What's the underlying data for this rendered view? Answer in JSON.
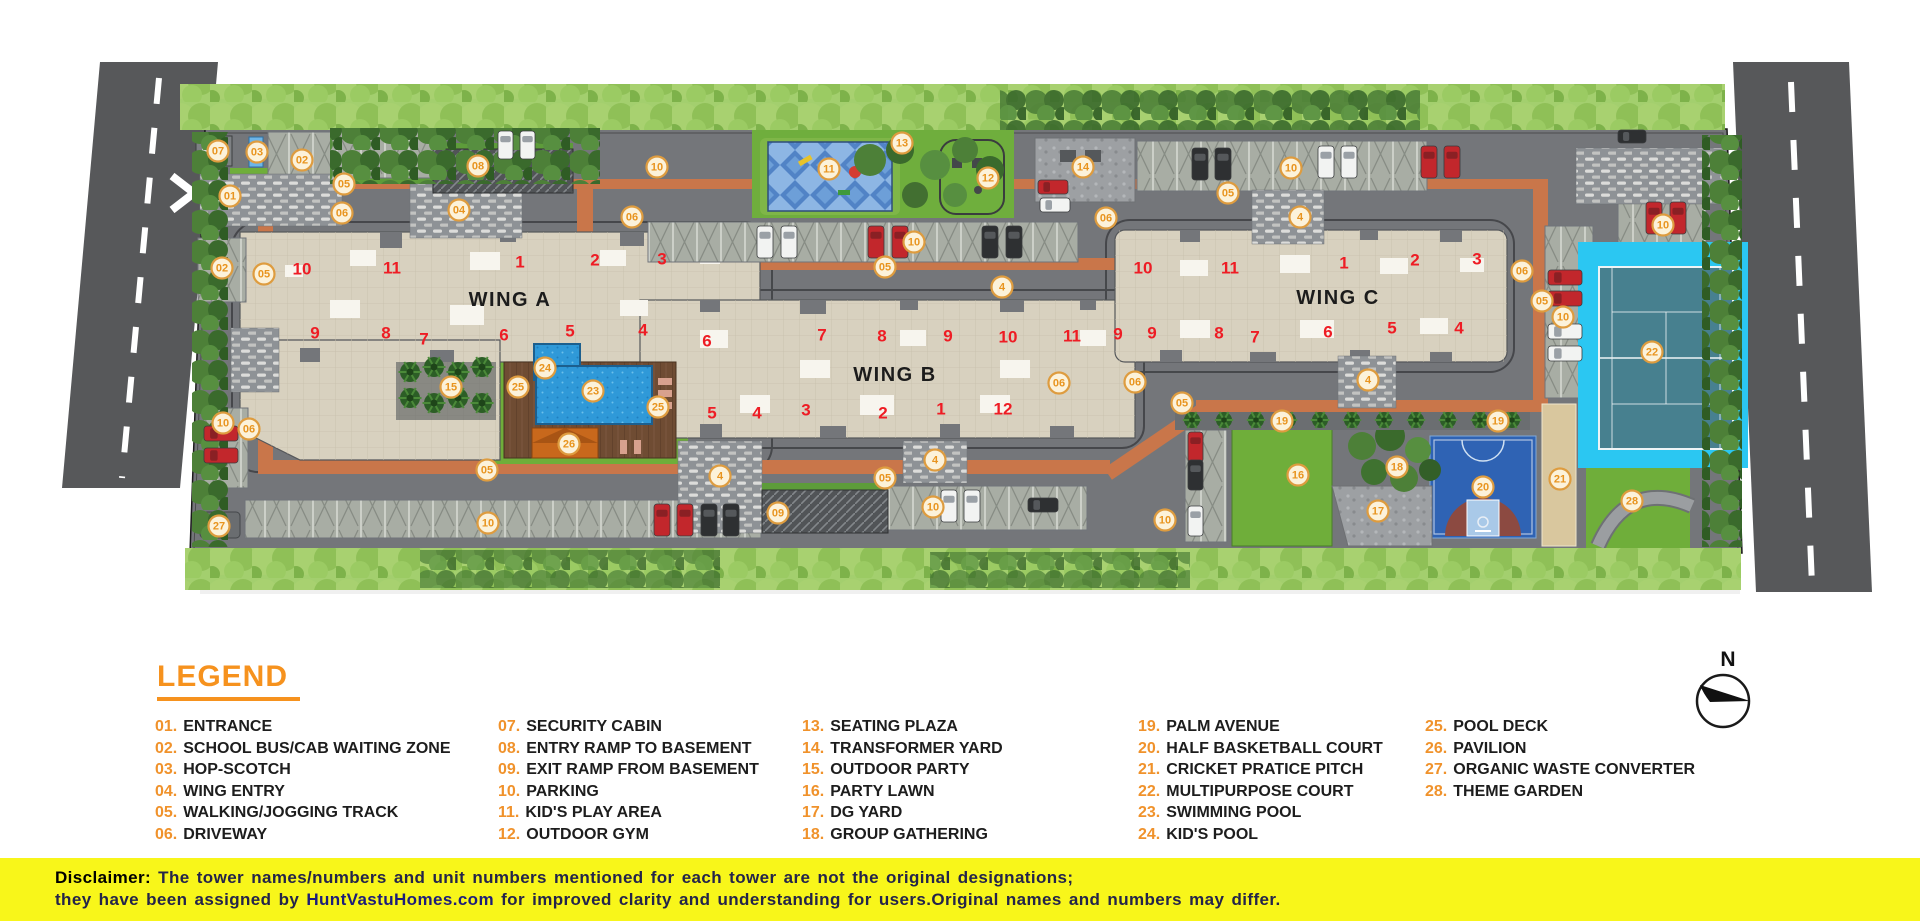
{
  "plan": {
    "wing_labels": [
      {
        "t": "WING A",
        "x": 510,
        "y": 300
      },
      {
        "t": "WING B",
        "x": 895,
        "y": 375
      },
      {
        "t": "WING C",
        "x": 1338,
        "y": 298
      }
    ],
    "unit_numbers": [
      {
        "t": "10",
        "x": 302,
        "y": 269
      },
      {
        "t": "11",
        "x": 392,
        "y": 268
      },
      {
        "t": "1",
        "x": 520,
        "y": 262
      },
      {
        "t": "2",
        "x": 595,
        "y": 260
      },
      {
        "t": "3",
        "x": 662,
        "y": 259
      },
      {
        "t": "9",
        "x": 315,
        "y": 333
      },
      {
        "t": "8",
        "x": 386,
        "y": 333
      },
      {
        "t": "7",
        "x": 424,
        "y": 339
      },
      {
        "t": "6",
        "x": 504,
        "y": 335
      },
      {
        "t": "5",
        "x": 570,
        "y": 331
      },
      {
        "t": "4",
        "x": 643,
        "y": 330
      },
      {
        "t": "6",
        "x": 707,
        "y": 341
      },
      {
        "t": "7",
        "x": 822,
        "y": 335
      },
      {
        "t": "8",
        "x": 882,
        "y": 336
      },
      {
        "t": "9",
        "x": 948,
        "y": 336
      },
      {
        "t": "10",
        "x": 1008,
        "y": 337
      },
      {
        "t": "11",
        "x": 1072,
        "y": 336
      },
      {
        "t": "9",
        "x": 1118,
        "y": 334
      },
      {
        "t": "5",
        "x": 712,
        "y": 413
      },
      {
        "t": "4",
        "x": 757,
        "y": 413
      },
      {
        "t": "3",
        "x": 806,
        "y": 410
      },
      {
        "t": "2",
        "x": 883,
        "y": 413
      },
      {
        "t": "1",
        "x": 941,
        "y": 409
      },
      {
        "t": "12",
        "x": 1003,
        "y": 409
      },
      {
        "t": "10",
        "x": 1143,
        "y": 268
      },
      {
        "t": "11",
        "x": 1230,
        "y": 268
      },
      {
        "t": "1",
        "x": 1344,
        "y": 263
      },
      {
        "t": "2",
        "x": 1415,
        "y": 260
      },
      {
        "t": "3",
        "x": 1477,
        "y": 259
      },
      {
        "t": "9",
        "x": 1152,
        "y": 333
      },
      {
        "t": "8",
        "x": 1219,
        "y": 333
      },
      {
        "t": "7",
        "x": 1255,
        "y": 337
      },
      {
        "t": "6",
        "x": 1328,
        "y": 332
      },
      {
        "t": "5",
        "x": 1392,
        "y": 328
      },
      {
        "t": "4",
        "x": 1459,
        "y": 328
      }
    ],
    "markers": [
      {
        "t": "07",
        "x": 218,
        "y": 151
      },
      {
        "t": "03",
        "x": 257,
        "y": 152
      },
      {
        "t": "02",
        "x": 302,
        "y": 160
      },
      {
        "t": "05",
        "x": 344,
        "y": 184
      },
      {
        "t": "01",
        "x": 230,
        "y": 196
      },
      {
        "t": "06",
        "x": 342,
        "y": 213
      },
      {
        "t": "04",
        "x": 459,
        "y": 210
      },
      {
        "t": "08",
        "x": 478,
        "y": 166
      },
      {
        "t": "02",
        "x": 222,
        "y": 268
      },
      {
        "t": "05",
        "x": 264,
        "y": 274
      },
      {
        "t": "10",
        "x": 657,
        "y": 167
      },
      {
        "t": "06",
        "x": 632,
        "y": 217
      },
      {
        "t": "11",
        "x": 829,
        "y": 169
      },
      {
        "t": "13",
        "x": 902,
        "y": 143
      },
      {
        "t": "12",
        "x": 988,
        "y": 178
      },
      {
        "t": "14",
        "x": 1083,
        "y": 167
      },
      {
        "t": "10",
        "x": 914,
        "y": 242
      },
      {
        "t": "05",
        "x": 885,
        "y": 267
      },
      {
        "t": "4",
        "x": 1002,
        "y": 287
      },
      {
        "t": "06",
        "x": 1106,
        "y": 218
      },
      {
        "t": "10",
        "x": 1291,
        "y": 168
      },
      {
        "t": "05",
        "x": 1228,
        "y": 193
      },
      {
        "t": "4",
        "x": 1300,
        "y": 217
      },
      {
        "t": "10",
        "x": 1663,
        "y": 225
      },
      {
        "t": "06",
        "x": 1522,
        "y": 271
      },
      {
        "t": "05",
        "x": 1542,
        "y": 301
      },
      {
        "t": "10",
        "x": 1563,
        "y": 317
      },
      {
        "t": "22",
        "x": 1652,
        "y": 352
      },
      {
        "t": "06",
        "x": 1135,
        "y": 382
      },
      {
        "t": "05",
        "x": 1182,
        "y": 403
      },
      {
        "t": "4",
        "x": 1368,
        "y": 380
      },
      {
        "t": "19",
        "x": 1282,
        "y": 421
      },
      {
        "t": "19",
        "x": 1498,
        "y": 421
      },
      {
        "t": "16",
        "x": 1298,
        "y": 475
      },
      {
        "t": "18",
        "x": 1397,
        "y": 467
      },
      {
        "t": "17",
        "x": 1378,
        "y": 511
      },
      {
        "t": "20",
        "x": 1483,
        "y": 487
      },
      {
        "t": "21",
        "x": 1560,
        "y": 479
      },
      {
        "t": "28",
        "x": 1632,
        "y": 501
      },
      {
        "t": "15",
        "x": 451,
        "y": 387
      },
      {
        "t": "24",
        "x": 545,
        "y": 368
      },
      {
        "t": "25",
        "x": 518,
        "y": 387
      },
      {
        "t": "23",
        "x": 593,
        "y": 391
      },
      {
        "t": "25",
        "x": 658,
        "y": 407
      },
      {
        "t": "26",
        "x": 569,
        "y": 444
      },
      {
        "t": "06",
        "x": 249,
        "y": 429
      },
      {
        "t": "10",
        "x": 223,
        "y": 423
      },
      {
        "t": "27",
        "x": 219,
        "y": 526
      },
      {
        "t": "05",
        "x": 487,
        "y": 470
      },
      {
        "t": "10",
        "x": 488,
        "y": 523
      },
      {
        "t": "4",
        "x": 720,
        "y": 476
      },
      {
        "t": "05",
        "x": 885,
        "y": 478
      },
      {
        "t": "4",
        "x": 935,
        "y": 460
      },
      {
        "t": "09",
        "x": 778,
        "y": 513
      },
      {
        "t": "10",
        "x": 933,
        "y": 507
      },
      {
        "t": "06",
        "x": 1059,
        "y": 383
      },
      {
        "t": "10",
        "x": 1165,
        "y": 520
      }
    ],
    "cars": [
      {
        "c": "white",
        "x": 757,
        "y": 226,
        "w": 16,
        "h": 32
      },
      {
        "c": "white",
        "x": 781,
        "y": 226,
        "w": 16,
        "h": 32
      },
      {
        "c": "red",
        "x": 868,
        "y": 226,
        "w": 16,
        "h": 32
      },
      {
        "c": "red",
        "x": 892,
        "y": 226,
        "w": 16,
        "h": 32
      },
      {
        "c": "dark",
        "x": 982,
        "y": 226,
        "w": 16,
        "h": 32
      },
      {
        "c": "dark",
        "x": 1006,
        "y": 226,
        "w": 16,
        "h": 32
      },
      {
        "c": "dark",
        "x": 1192,
        "y": 148,
        "w": 16,
        "h": 32
      },
      {
        "c": "dark",
        "x": 1215,
        "y": 148,
        "w": 16,
        "h": 32
      },
      {
        "c": "white",
        "x": 1318,
        "y": 146,
        "w": 16,
        "h": 32
      },
      {
        "c": "white",
        "x": 1341,
        "y": 146,
        "w": 16,
        "h": 32
      },
      {
        "c": "red",
        "x": 1421,
        "y": 146,
        "w": 16,
        "h": 32
      },
      {
        "c": "red",
        "x": 1444,
        "y": 146,
        "w": 16,
        "h": 32
      },
      {
        "c": "red",
        "x": 1646,
        "y": 202,
        "w": 16,
        "h": 32
      },
      {
        "c": "red",
        "x": 1670,
        "y": 202,
        "w": 16,
        "h": 32
      },
      {
        "c": "red",
        "x": 1548,
        "y": 270,
        "w": 34,
        "h": 15
      },
      {
        "c": "red",
        "x": 1548,
        "y": 291,
        "w": 34,
        "h": 15
      },
      {
        "c": "white",
        "x": 1548,
        "y": 324,
        "w": 34,
        "h": 15
      },
      {
        "c": "white",
        "x": 1548,
        "y": 346,
        "w": 34,
        "h": 15
      },
      {
        "c": "red",
        "x": 1188,
        "y": 432,
        "w": 15,
        "h": 30
      },
      {
        "c": "dark",
        "x": 1188,
        "y": 460,
        "w": 15,
        "h": 30
      },
      {
        "c": "white",
        "x": 1188,
        "y": 506,
        "w": 15,
        "h": 30
      },
      {
        "c": "red",
        "x": 654,
        "y": 504,
        "w": 16,
        "h": 32
      },
      {
        "c": "red",
        "x": 677,
        "y": 504,
        "w": 16,
        "h": 32
      },
      {
        "c": "dark",
        "x": 701,
        "y": 504,
        "w": 16,
        "h": 32
      },
      {
        "c": "dark",
        "x": 723,
        "y": 504,
        "w": 16,
        "h": 32
      },
      {
        "c": "red",
        "x": 204,
        "y": 426,
        "w": 34,
        "h": 15
      },
      {
        "c": "red",
        "x": 204,
        "y": 448,
        "w": 34,
        "h": 15
      },
      {
        "c": "white",
        "x": 941,
        "y": 490,
        "w": 16,
        "h": 32
      },
      {
        "c": "white",
        "x": 964,
        "y": 490,
        "w": 16,
        "h": 32
      },
      {
        "c": "dark",
        "x": 1028,
        "y": 498,
        "w": 30,
        "h": 14
      },
      {
        "c": "red",
        "x": 1038,
        "y": 180,
        "w": 30,
        "h": 14
      },
      {
        "c": "white",
        "x": 1040,
        "y": 198,
        "w": 30,
        "h": 14
      },
      {
        "c": "white",
        "x": 498,
        "y": 131,
        "w": 15,
        "h": 28
      },
      {
        "c": "white",
        "x": 520,
        "y": 131,
        "w": 15,
        "h": 28
      },
      {
        "c": "dark",
        "x": 1618,
        "y": 130,
        "w": 28,
        "h": 13
      }
    ],
    "palms_party": [
      {
        "x": 410,
        "y": 372
      },
      {
        "x": 434,
        "y": 367
      },
      {
        "x": 458,
        "y": 372
      },
      {
        "x": 482,
        "y": 367
      },
      {
        "x": 410,
        "y": 398
      },
      {
        "x": 434,
        "y": 403
      },
      {
        "x": 458,
        "y": 398
      },
      {
        "x": 482,
        "y": 403
      }
    ],
    "palms_avenue": [
      {
        "x": 1192,
        "y": 420
      },
      {
        "x": 1224,
        "y": 420
      },
      {
        "x": 1256,
        "y": 420
      },
      {
        "x": 1288,
        "y": 420
      },
      {
        "x": 1320,
        "y": 420
      },
      {
        "x": 1352,
        "y": 420
      },
      {
        "x": 1384,
        "y": 420
      },
      {
        "x": 1416,
        "y": 420
      },
      {
        "x": 1448,
        "y": 420
      },
      {
        "x": 1480,
        "y": 420
      },
      {
        "x": 1512,
        "y": 420
      }
    ]
  },
  "legend": {
    "title": "LEGEND",
    "columns": [
      [
        {
          "n": "01.",
          "t": "ENTRANCE"
        },
        {
          "n": "02.",
          "t": "SCHOOL BUS/CAB WAITING ZONE"
        },
        {
          "n": "03.",
          "t": "HOP-SCOTCH"
        },
        {
          "n": "04.",
          "t": "WING ENTRY"
        },
        {
          "n": "05.",
          "t": "WALKING/JOGGING TRACK"
        },
        {
          "n": "06.",
          "t": "DRIVEWAY"
        }
      ],
      [
        {
          "n": "07.",
          "t": "SECURITY CABIN"
        },
        {
          "n": "08.",
          "t": "ENTRY RAMP TO BASEMENT"
        },
        {
          "n": "09.",
          "t": "EXIT RAMP FROM BASEMENT"
        },
        {
          "n": "10.",
          "t": "PARKING"
        },
        {
          "n": "11.",
          "t": "KID'S PLAY AREA"
        },
        {
          "n": "12.",
          "t": "OUTDOOR GYM"
        }
      ],
      [
        {
          "n": "13.",
          "t": "SEATING PLAZA"
        },
        {
          "n": "14.",
          "t": "TRANSFORMER YARD"
        },
        {
          "n": "15.",
          "t": "OUTDOOR PARTY"
        },
        {
          "n": "16.",
          "t": "PARTY LAWN"
        },
        {
          "n": "17.",
          "t": "DG YARD"
        },
        {
          "n": "18.",
          "t": "GROUP GATHERING"
        }
      ],
      [
        {
          "n": "19.",
          "t": "PALM AVENUE"
        },
        {
          "n": "20.",
          "t": "HALF BASKETBALL COURT"
        },
        {
          "n": "21.",
          "t": "CRICKET PRATICE PITCH"
        },
        {
          "n": "22.",
          "t": "MULTIPURPOSE COURT"
        },
        {
          "n": "23.",
          "t": "SWIMMING POOL"
        },
        {
          "n": "24.",
          "t": "KID'S POOL"
        }
      ],
      [
        {
          "n": "25.",
          "t": "POOL DECK"
        },
        {
          "n": "26.",
          "t": "PAVILION"
        },
        {
          "n": "27.",
          "t": "ORGANIC WASTE CONVERTER"
        },
        {
          "n": "28.",
          "t": "THEME GARDEN"
        }
      ]
    ]
  },
  "compass": {
    "label": "N"
  },
  "disclaimer": {
    "heading": "Disclaimer:",
    "line1": " The tower names/numbers and unit numbers mentioned for each tower are not the original designations;",
    "line2_pre": "they have been assigned by ",
    "line2_brand": "HuntVastuHomes.com",
    "line2_post": " for improved clarity and understanding for users.Original names and numbers may differ."
  },
  "colors": {
    "accent_orange": "#F6921E",
    "legend_number": "#F0922B",
    "marker_ring": "#DE9C3F",
    "unit_red": "#EE1C24",
    "disclaimer_yellow": "#F8F61A",
    "road_gray": "#57585A",
    "track_orange": "#C9764A",
    "building_beige": "#D8D1BF",
    "pool_blue": "#2F99D8",
    "court_cyan": "#2BC7F2"
  }
}
